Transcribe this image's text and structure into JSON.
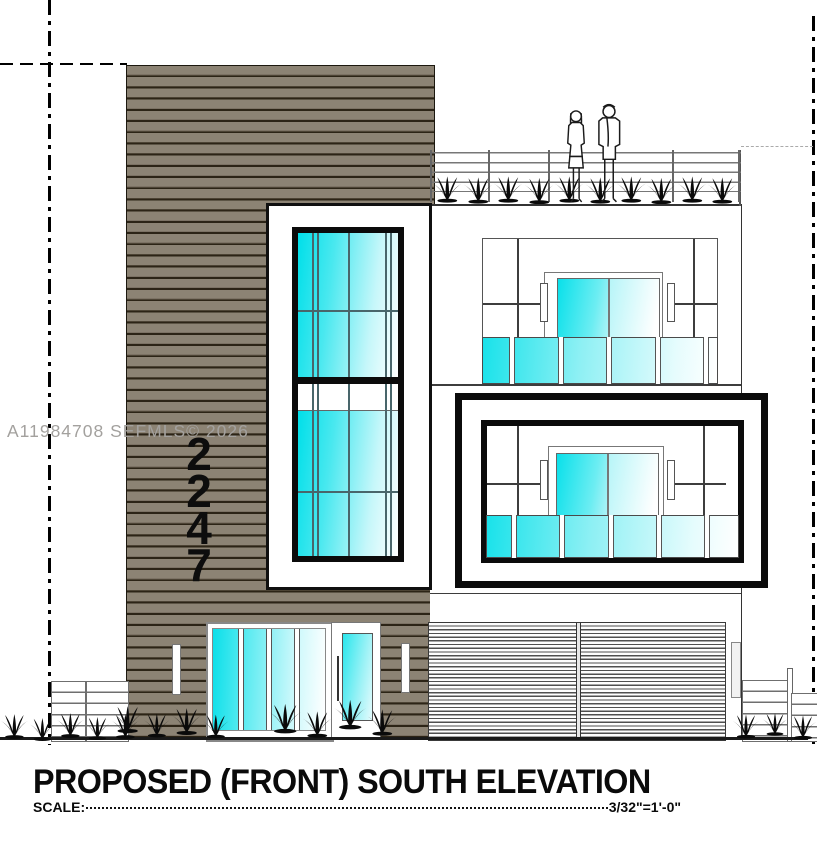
{
  "watermark": "A11984708  SEFMLS© 2026",
  "house_number": {
    "digits": [
      "2",
      "2",
      "4",
      "7"
    ]
  },
  "titleblock": {
    "title": "PROPOSED (FRONT) SOUTH ELEVATION",
    "scale_label": "SCALE:",
    "scale_value": "3/32\"=1'-0\""
  },
  "colors": {
    "siding": "#8c8374",
    "siding_line": "#2c2416",
    "glass_cyan": "#00dfe9",
    "frame_black": "#0b0b0b",
    "drawing_line": "#444444"
  }
}
